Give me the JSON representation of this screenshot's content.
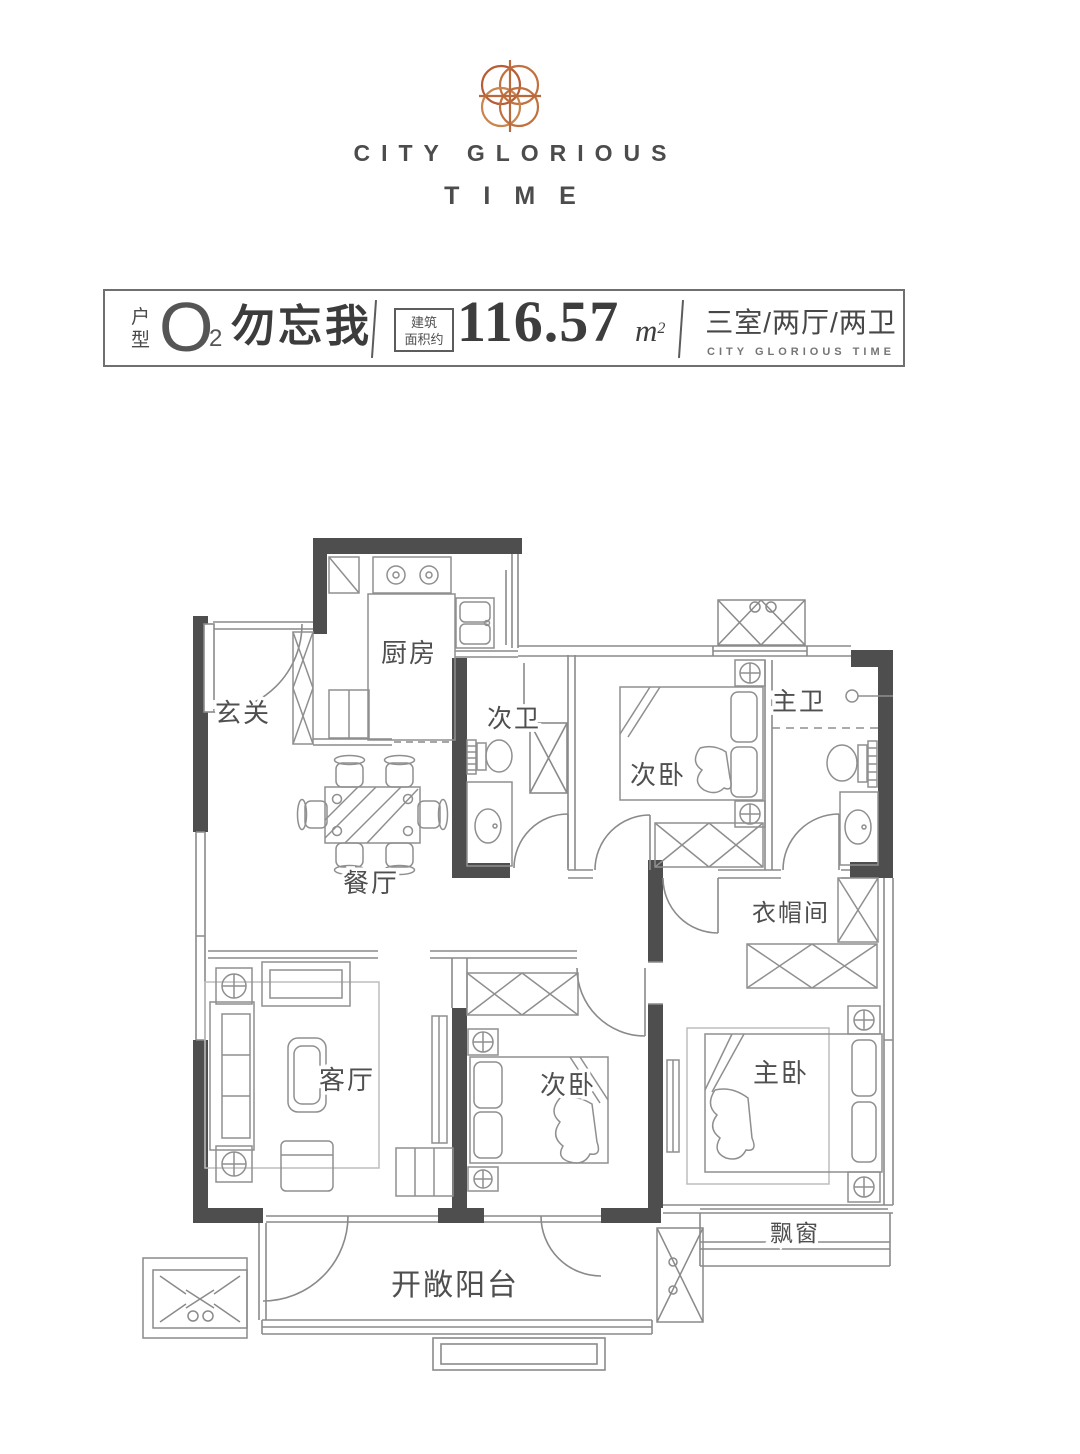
{
  "brand": {
    "name_line1": "CITY GLORIOUS",
    "name_line2": "TIME",
    "logo_color": "#c1713f"
  },
  "header": {
    "unit_label_top": "户",
    "unit_label_bottom": "型",
    "unit_code": "O",
    "unit_code_sub": "2",
    "unit_name": "勿忘我",
    "area_note_line1": "建筑",
    "area_note_line2": "面积约",
    "area_value": "116.57",
    "area_unit_base": "m",
    "area_unit_sup": "2",
    "layout_summary": "三室/两厅/两卫",
    "layout_summary_en": "CITY GLORIOUS TIME"
  },
  "floorplan": {
    "rooms": [
      {
        "key": "entry",
        "label": "玄关"
      },
      {
        "key": "kitchen",
        "label": "厨房"
      },
      {
        "key": "bath-2",
        "label": "次卫"
      },
      {
        "key": "bedroom-2",
        "label": "次卧"
      },
      {
        "key": "master-bath",
        "label": "主卫"
      },
      {
        "key": "dining",
        "label": "餐厅"
      },
      {
        "key": "cloakroom",
        "label": "衣帽间"
      },
      {
        "key": "living",
        "label": "客厅"
      },
      {
        "key": "bedroom-1",
        "label": "次卧"
      },
      {
        "key": "master-bedroom",
        "label": "主卧"
      },
      {
        "key": "bay-window",
        "label": "飘窗"
      },
      {
        "key": "balcony",
        "label": "开敞阳台"
      }
    ],
    "colors": {
      "wall": "#4e4e4e",
      "line": "#8f8f8f",
      "label": "#4f4f4f"
    }
  }
}
